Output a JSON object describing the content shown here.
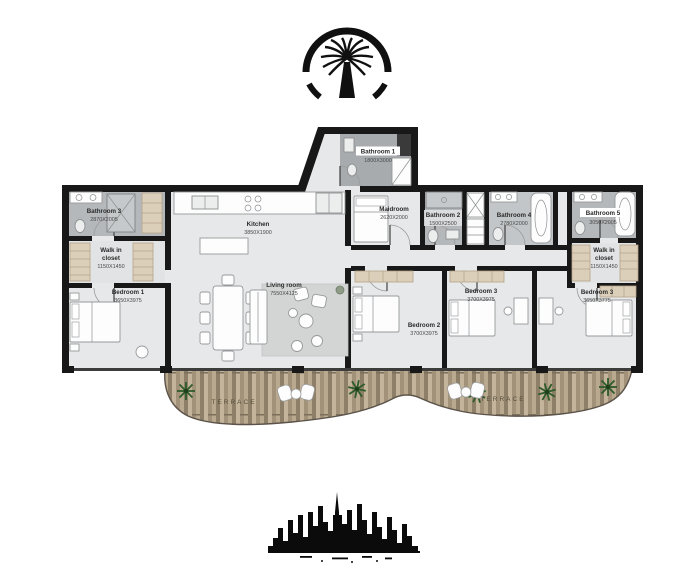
{
  "labels": {
    "bathroom1": {
      "name": "Bathroom 1",
      "dims": "1800X3000"
    },
    "bathroom3_left": {
      "name": "Bathroom 3",
      "dims": "2870X2005"
    },
    "walkin_left": {
      "l1": "Walk in",
      "l2": "closet",
      "dims": "1150X1450"
    },
    "bedroom1": {
      "name": "Bedroom 1",
      "dims": "3650X3975"
    },
    "kitchen": {
      "name": "Kitchen",
      "dims": "3850X1900"
    },
    "maidroom": {
      "name": "Maidroom",
      "dims": "2620X2000"
    },
    "bathroom2": {
      "name": "Bathroom 2",
      "dims": "1500X2500"
    },
    "bathroom4": {
      "name": "Bathroom 4",
      "dims": "2780X2000"
    },
    "bathroom5": {
      "name": "Bathroom 5",
      "dims": "3050X2005"
    },
    "walkin_right": {
      "l1": "Walk in",
      "l2": "closet",
      "dims": "1150X1450"
    },
    "living": {
      "name": "Living room",
      "dims": "7550X4125"
    },
    "bedroom2": {
      "name": "Bedroom 2",
      "dims": "3700X3975"
    },
    "bedroom3": {
      "name": "Bedroom 3",
      "dims": "3700X3975"
    },
    "bedroom3b": {
      "name": "Bedroom 3",
      "dims": "3650X3775"
    },
    "terrace_left": {
      "name": "TERRACE"
    },
    "terrace_right": {
      "name": "TERRACE"
    }
  },
  "colors": {
    "wall": "#181818",
    "floor": "#e7e8e9",
    "bath_floor": "#b5b8bb",
    "terrace_wood": "#ab9b83",
    "plant_green": "#2e5b2a",
    "text": "#2b2b2b"
  }
}
